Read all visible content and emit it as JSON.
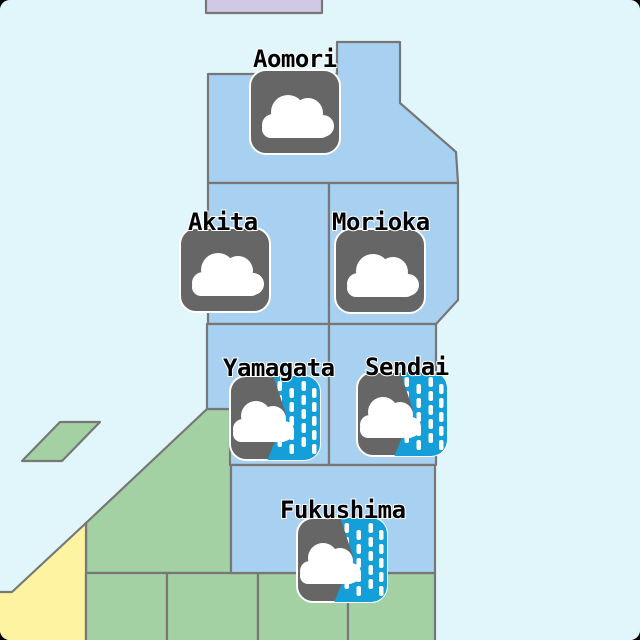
{
  "page": {
    "description": "Tohoku region weather map with city weather icons",
    "outside_color": "#000000",
    "corner_radius": 10
  },
  "map": {
    "colors": {
      "sea": "#e1f6fb",
      "prefecture": "#a8d1f1",
      "green": "#a3d1a3",
      "yellow": "#fdf3a1",
      "purple": "#cfc9e6",
      "border": "#777777",
      "icon_base": "#666666",
      "rain_blue": "#149fd9",
      "cloud": "#ffffff",
      "label_text": "#000000",
      "label_outline": "#ffffff"
    },
    "regions": [
      {
        "id": "hokkaido-tip",
        "fill": "purple",
        "interactable": false,
        "points": [
          [
            206,
            -3
          ],
          [
            322,
            -3
          ],
          [
            322,
            13
          ],
          [
            206,
            13
          ]
        ]
      },
      {
        "id": "sado-island",
        "fill": "green",
        "interactable": false,
        "points": [
          [
            60,
            422
          ],
          [
            100,
            422
          ],
          [
            62,
            461
          ],
          [
            22,
            461
          ]
        ]
      },
      {
        "id": "niigata",
        "fill": "green",
        "interactable": false,
        "points": [
          [
            207,
            409
          ],
          [
            231,
            409
          ],
          [
            231,
            573
          ],
          [
            86,
            573
          ],
          [
            86,
            523
          ]
        ]
      },
      {
        "id": "hokuriku",
        "fill": "yellow",
        "interactable": false,
        "points": [
          [
            86,
            523
          ],
          [
            86,
            643
          ],
          [
            -3,
            643
          ],
          [
            -3,
            592
          ],
          [
            12,
            592
          ]
        ]
      },
      {
        "id": "kanto-west",
        "fill": "green",
        "interactable": false,
        "points": [
          [
            86,
            573
          ],
          [
            167,
            573
          ],
          [
            167,
            643
          ],
          [
            86,
            643
          ]
        ]
      },
      {
        "id": "kanto-mid-west",
        "fill": "green",
        "interactable": false,
        "points": [
          [
            167,
            573
          ],
          [
            258,
            573
          ],
          [
            258,
            643
          ],
          [
            167,
            643
          ]
        ]
      },
      {
        "id": "kanto-mid-east",
        "fill": "green",
        "interactable": false,
        "points": [
          [
            258,
            573
          ],
          [
            348,
            573
          ],
          [
            348,
            643
          ],
          [
            258,
            643
          ]
        ]
      },
      {
        "id": "kanto-east",
        "fill": "green",
        "interactable": false,
        "points": [
          [
            348,
            573
          ],
          [
            435,
            573
          ],
          [
            435,
            643
          ],
          [
            348,
            643
          ]
        ]
      },
      {
        "id": "aomori",
        "fill": "prefecture",
        "interactable": true,
        "points": [
          [
            208,
            74
          ],
          [
            337,
            74
          ],
          [
            337,
            42
          ],
          [
            400,
            42
          ],
          [
            400,
            103
          ],
          [
            456,
            152
          ],
          [
            458,
            183
          ],
          [
            208,
            183
          ]
        ]
      },
      {
        "id": "akita",
        "fill": "prefecture",
        "interactable": true,
        "points": [
          [
            208,
            183
          ],
          [
            329,
            183
          ],
          [
            329,
            324
          ],
          [
            208,
            324
          ]
        ]
      },
      {
        "id": "iwate",
        "fill": "prefecture",
        "interactable": true,
        "points": [
          [
            329,
            183
          ],
          [
            458,
            183
          ],
          [
            458,
            300
          ],
          [
            436,
            324
          ],
          [
            329,
            324
          ]
        ]
      },
      {
        "id": "yamagata",
        "fill": "prefecture",
        "interactable": true,
        "points": [
          [
            207,
            324
          ],
          [
            329,
            324
          ],
          [
            329,
            465
          ],
          [
            230,
            465
          ],
          [
            230,
            409
          ],
          [
            207,
            409
          ]
        ]
      },
      {
        "id": "miyagi",
        "fill": "prefecture",
        "interactable": true,
        "points": [
          [
            329,
            324
          ],
          [
            436,
            324
          ],
          [
            436,
            465
          ],
          [
            329,
            465
          ]
        ]
      },
      {
        "id": "fukushima",
        "fill": "prefecture",
        "interactable": true,
        "points": [
          [
            231,
            465
          ],
          [
            435,
            465
          ],
          [
            435,
            573
          ],
          [
            231,
            573
          ]
        ]
      }
    ],
    "cities": [
      {
        "name": "Aomori",
        "weather": "cloudy",
        "icon_name": "cloud-icon",
        "icon": {
          "x": 250,
          "y": 70,
          "w": 90,
          "h": 84
        },
        "label": {
          "x": 253,
          "baseline": 67
        }
      },
      {
        "name": "Akita",
        "weather": "cloudy",
        "icon_name": "cloud-icon",
        "icon": {
          "x": 180,
          "y": 228,
          "w": 90,
          "h": 84
        },
        "label": {
          "x": 188,
          "baseline": 230
        }
      },
      {
        "name": "Morioka",
        "weather": "cloudy",
        "icon_name": "cloud-icon",
        "icon": {
          "x": 335,
          "y": 229,
          "w": 90,
          "h": 84
        },
        "label": {
          "x": 332,
          "baseline": 230
        }
      },
      {
        "name": "Yamagata",
        "weather": "rain",
        "icon_name": "cloud-rain-icon",
        "icon": {
          "x": 230,
          "y": 376,
          "w": 90,
          "h": 84
        },
        "label": {
          "x": 223,
          "baseline": 376
        }
      },
      {
        "name": "Sendai",
        "weather": "rain",
        "icon_name": "cloud-rain-icon",
        "icon": {
          "x": 357,
          "y": 372,
          "w": 90,
          "h": 84
        },
        "label": {
          "x": 365,
          "baseline": 375
        }
      },
      {
        "name": "Fukushima",
        "weather": "rain",
        "icon_name": "cloud-rain-icon",
        "icon": {
          "x": 297,
          "y": 518,
          "w": 90,
          "h": 84
        },
        "label": {
          "x": 280,
          "baseline": 518
        }
      }
    ]
  }
}
